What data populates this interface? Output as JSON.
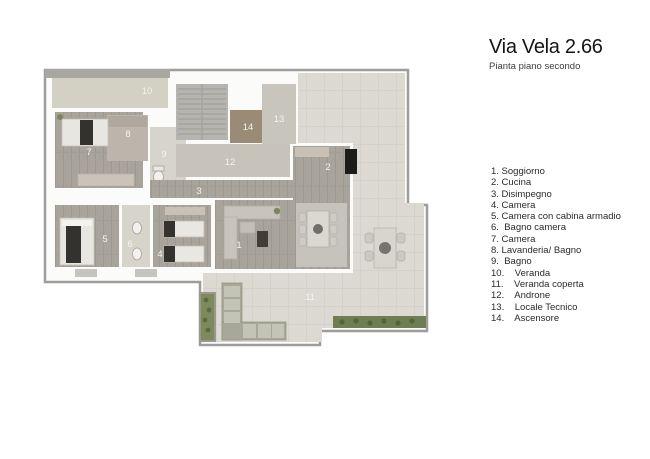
{
  "header": {
    "title": "Via Vela 2.66",
    "subtitle": "Pianta piano secondo"
  },
  "legend": {
    "items": [
      "1. Soggiorno",
      "2. Cucina",
      "3. Disimpegno",
      "4. Camera",
      "5. Camera con cabina armadio",
      "6.  Bagno camera",
      "7. Camera",
      "8. Lavanderia/ Bagno",
      "9.  Bagno",
      "10.    Veranda",
      "11.    Veranda coperta",
      "12.    Androne",
      "13.    Locale Tecnico",
      "14.    Ascensore"
    ]
  },
  "plan": {
    "rooms": [
      {
        "num": "1",
        "name": "Soggiorno"
      },
      {
        "num": "2",
        "name": "Cucina"
      },
      {
        "num": "3",
        "name": "Disimpegno"
      },
      {
        "num": "4",
        "name": "Camera"
      },
      {
        "num": "5",
        "name": "Camera con cabina armadio"
      },
      {
        "num": "6",
        "name": "Bagno camera"
      },
      {
        "num": "7",
        "name": "Camera"
      },
      {
        "num": "8",
        "name": "Lavanderia/Bagno"
      },
      {
        "num": "9",
        "name": "Bagno"
      },
      {
        "num": "10",
        "name": "Veranda"
      },
      {
        "num": "11",
        "name": "Veranda coperta"
      },
      {
        "num": "12",
        "name": "Androne"
      },
      {
        "num": "13",
        "name": "Locale Tecnico"
      },
      {
        "num": "14",
        "name": "Ascensore"
      }
    ],
    "colors": {
      "wood": "#a9a49b",
      "bath_tile": "#d7d4cc",
      "hall_tile": "#c7c3bb",
      "terrace": "#dcd9d2",
      "veranda": "#d3d0c4",
      "stairs": "#b5b4b0",
      "elevator": "#9a8a76",
      "wall_outline": "#9d9d9d",
      "hedge": "#6f7d52",
      "dark_furniture": "#34322e"
    }
  }
}
